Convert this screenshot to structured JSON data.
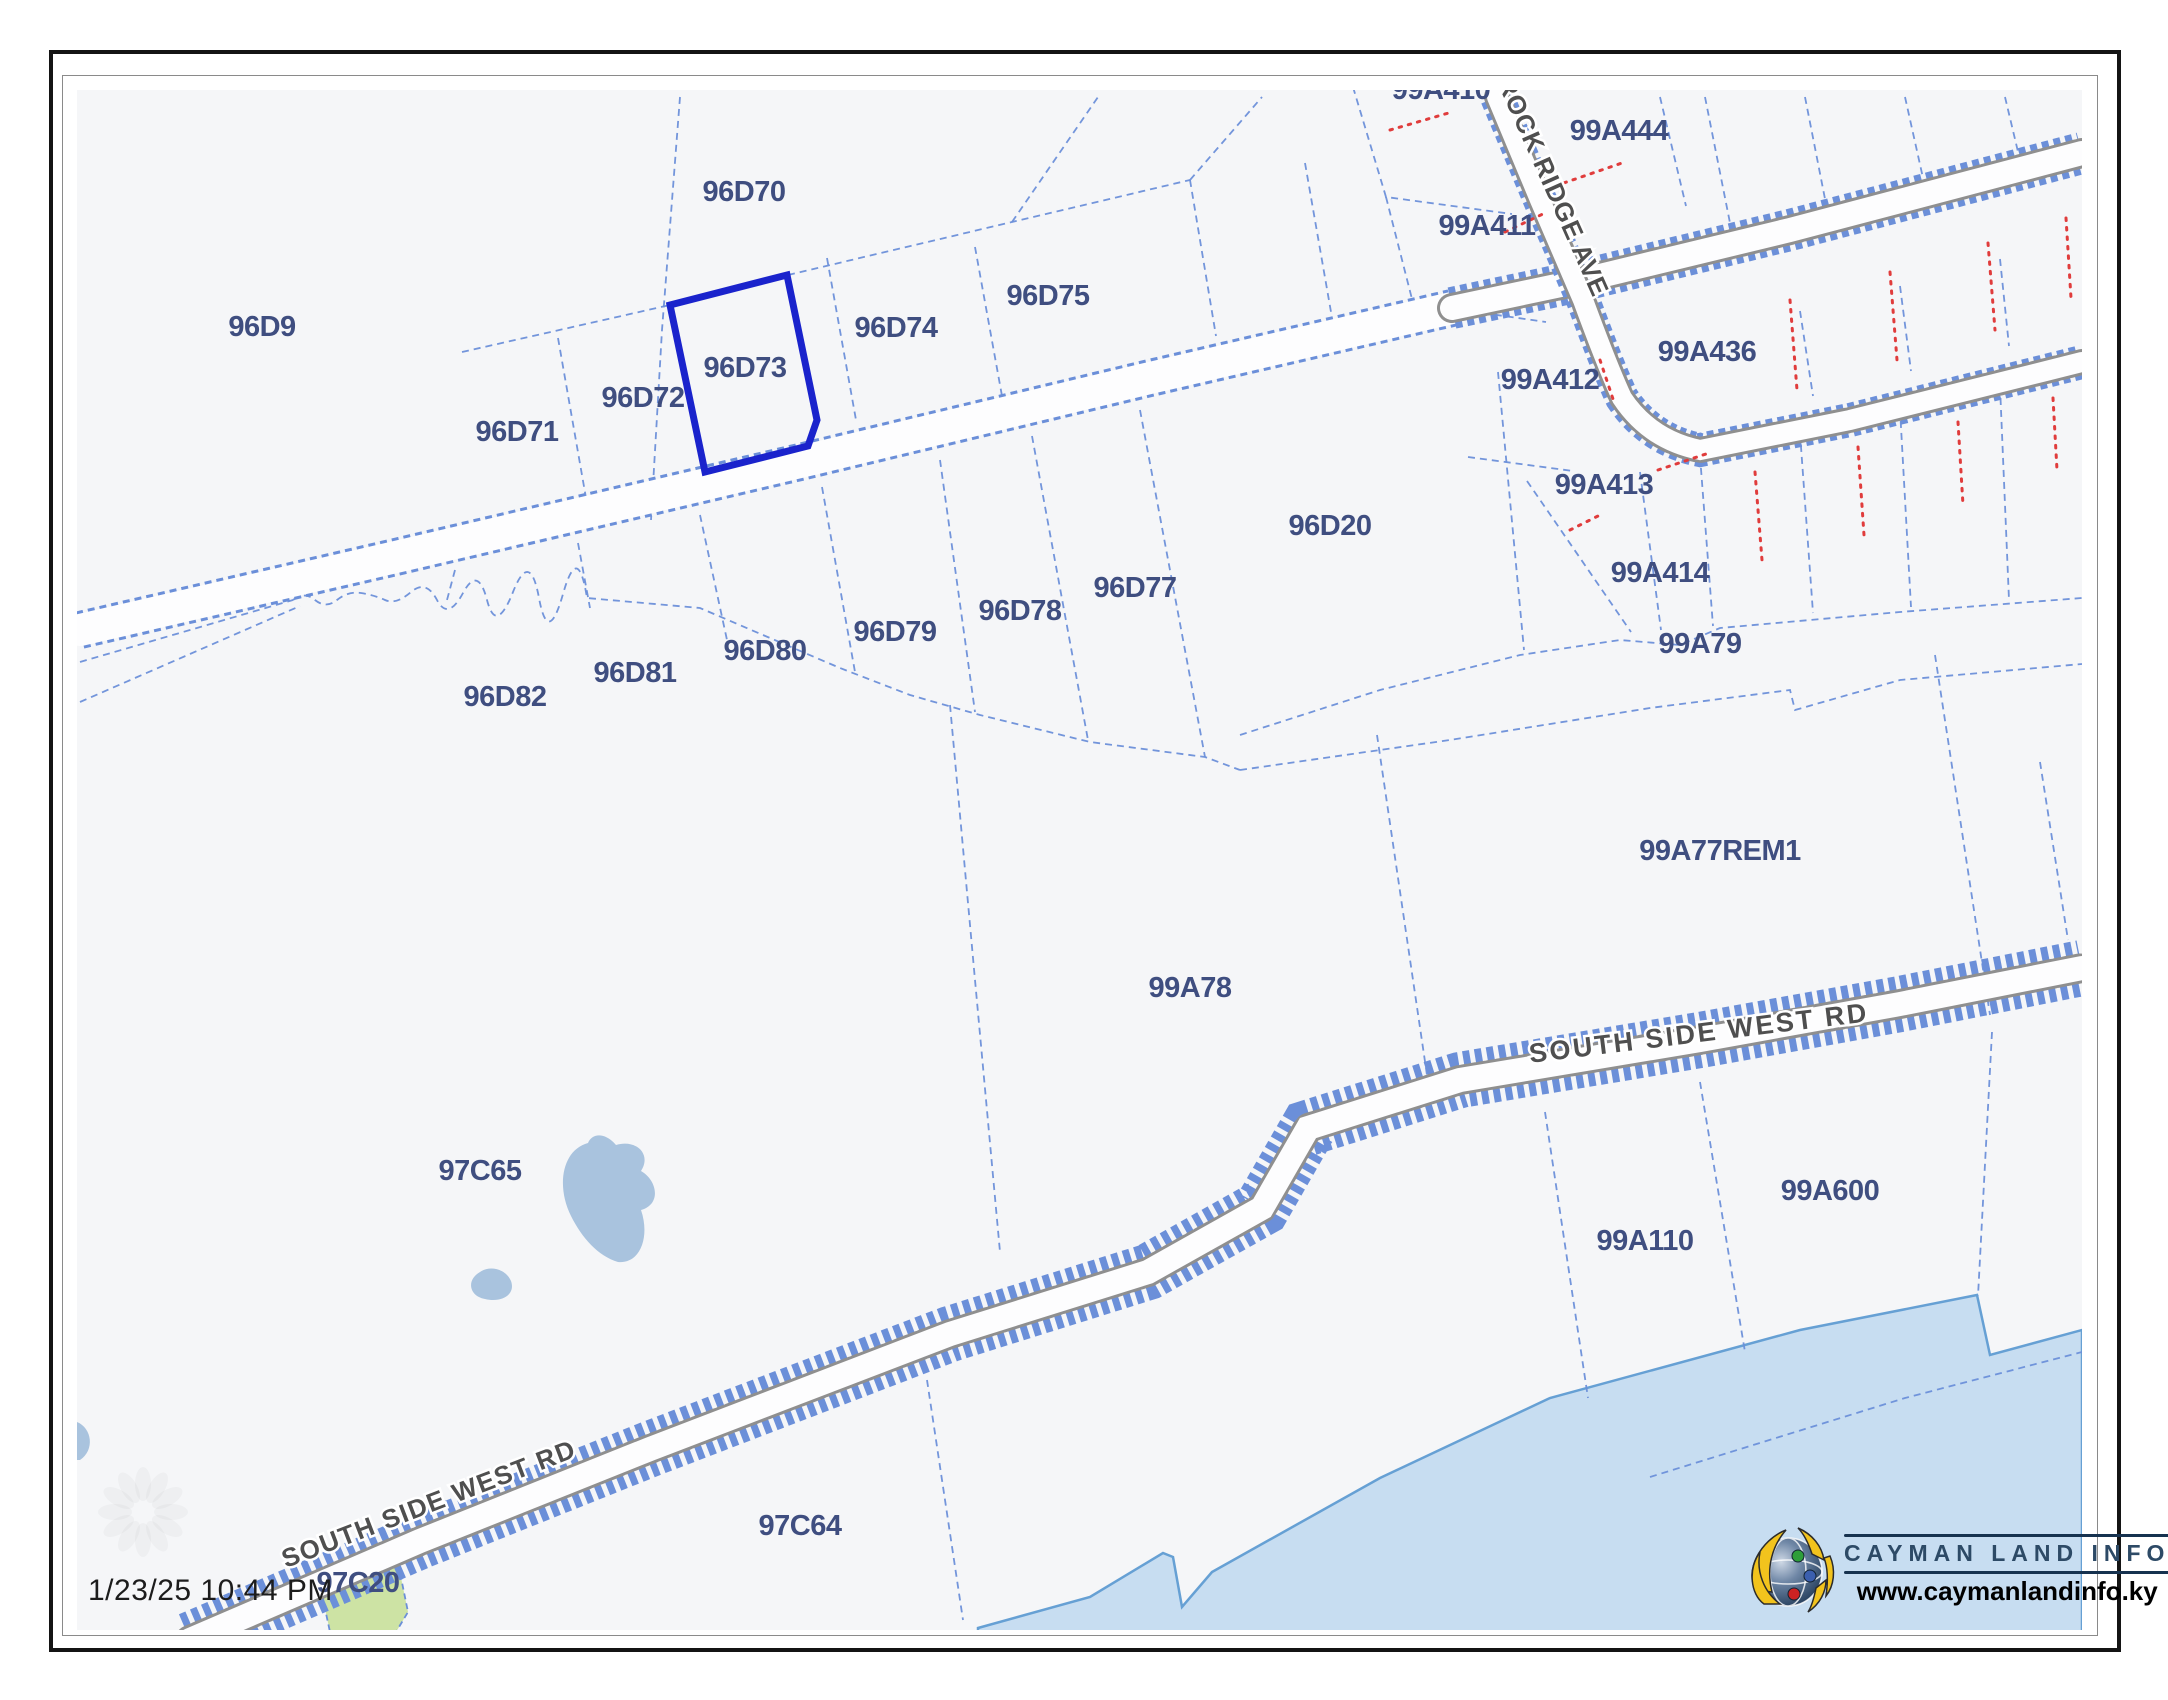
{
  "footer": {
    "timestamp": "1/23/25 10:44 PM"
  },
  "logo": {
    "title": "CAYMAN LAND INFO",
    "url": "www.caymanlandinfo.ky"
  },
  "map": {
    "bg": "#f5f6f8",
    "line_color": "#6b8fd9",
    "label_color": "#3f4e80",
    "road_label_color": "#4f4f4f",
    "road_case_color": "#8f8f8f",
    "road_fill_color": "#fdfdfe",
    "selected_color": "#1a23cc",
    "red_dotted_color": "#e03c3c",
    "sea_fill": "#c7ddf1",
    "sea_stroke": "#66a0d4",
    "pond_fill": "#a9c3de",
    "green_fill": "#cde3a4",
    "selected_parcel": {
      "id": "96D73",
      "path": "M670,305 L787,275 L817,420 L808,446 L705,472 Z"
    },
    "parcel_labels": [
      {
        "text": "96D9",
        "x": 262,
        "y": 336
      },
      {
        "text": "96D70",
        "x": 744,
        "y": 201
      },
      {
        "text": "96D71",
        "x": 517,
        "y": 441
      },
      {
        "text": "96D72",
        "x": 643,
        "y": 407
      },
      {
        "text": "96D73",
        "x": 745,
        "y": 377
      },
      {
        "text": "96D74",
        "x": 896,
        "y": 337
      },
      {
        "text": "96D75",
        "x": 1048,
        "y": 305
      },
      {
        "text": "96D20",
        "x": 1330,
        "y": 535
      },
      {
        "text": "96D77",
        "x": 1135,
        "y": 597
      },
      {
        "text": "96D78",
        "x": 1020,
        "y": 620
      },
      {
        "text": "96D79",
        "x": 895,
        "y": 641
      },
      {
        "text": "96D80",
        "x": 765,
        "y": 660
      },
      {
        "text": "96D81",
        "x": 635,
        "y": 682
      },
      {
        "text": "96D82",
        "x": 505,
        "y": 706
      },
      {
        "text": "99A410",
        "x": 1441,
        "y": 99
      },
      {
        "text": "99A444",
        "x": 1619,
        "y": 140
      },
      {
        "text": "99A411",
        "x": 1487,
        "y": 235
      },
      {
        "text": "99A412",
        "x": 1550,
        "y": 389
      },
      {
        "text": "99A436",
        "x": 1707,
        "y": 361
      },
      {
        "text": "99A413",
        "x": 1604,
        "y": 494
      },
      {
        "text": "99A414",
        "x": 1660,
        "y": 582
      },
      {
        "text": "99A79",
        "x": 1700,
        "y": 653
      },
      {
        "text": "99A77REM1",
        "x": 1720,
        "y": 860
      },
      {
        "text": "99A78",
        "x": 1190,
        "y": 997
      },
      {
        "text": "97C65",
        "x": 480,
        "y": 1180
      },
      {
        "text": "99A110",
        "x": 1645,
        "y": 1250
      },
      {
        "text": "99A600",
        "x": 1830,
        "y": 1200
      },
      {
        "text": "97C64",
        "x": 800,
        "y": 1535
      },
      {
        "text": "97C20",
        "x": 358,
        "y": 1592
      }
    ],
    "road_labels": [
      {
        "text": "ROCK RIDGE AVE",
        "x": 1545,
        "y": 190,
        "rot": 66,
        "size": 26,
        "ls": 1
      },
      {
        "text": "SOUTH SIDE WEST RD",
        "x": 1700,
        "y": 1042,
        "rot": -7,
        "size": 27,
        "ls": 2.5
      },
      {
        "text": "SOUTH SIDE WEST RD",
        "x": 432,
        "y": 1512,
        "rot": -21,
        "size": 26,
        "ls": 1.5
      }
    ],
    "roads": [
      {
        "name": "unpaved-main-road",
        "path": "M80,630 L400,556 L800,462 L1150,378 L1452,308",
        "blue_w": 38,
        "case_w": 0,
        "fill_w": 32
      },
      {
        "name": "main-road-east",
        "path": "M1452,308 L1575,282 L1790,230 L2082,153",
        "blue_w": 42,
        "case_w": 30,
        "fill_w": 24
      },
      {
        "name": "rock-ridge-ave",
        "path": "M1497,97 L1540,200 L1583,300 Q1608,368 1622,398 Q1650,440 1700,450 L1850,420 L2082,362",
        "blue_w": 34,
        "case_w": 26,
        "fill_w": 20
      },
      {
        "name": "south-side-west-rd",
        "path": "M190,1640 L420,1541 L650,1449 L950,1334 L1148,1272 L1262,1208 L1308,1128 L1460,1080 L1700,1040 L1900,1004 L2082,968",
        "blue_w": 56,
        "case_w": 30,
        "fill_w": 24
      }
    ],
    "boundaries": [
      "M680,97 L662,330 L651,520",
      "M462,352 L670,305",
      "M788,275 L1012,222 L1190,180",
      "M558,338 L586,498",
      "M827,258 L856,420",
      "M975,247 L1002,396",
      "M1190,180 L1216,336",
      "M1012,222 L1098,97",
      "M1190,180 L1262,97",
      "M1305,163 L1331,312",
      "M1353,87 L1386,197 L1512,214",
      "M1386,197 L1413,303 L1546,322",
      "M1660,97 L1686,206",
      "M1705,97 L1731,228",
      "M1805,97 L1826,204",
      "M1905,97 L1923,178",
      "M2005,97 L2019,156",
      "M1800,311 L1813,396",
      "M1900,286 L1911,371",
      "M2000,259 L2009,346",
      "M1700,456 L1713,626",
      "M1800,433 L1813,613",
      "M1900,409 L1911,607",
      "M2000,386 L2009,600",
      "M1640,472 L1661,630",
      "M1498,372 L1524,650",
      "M1468,457 L1573,471",
      "M1527,481 L1631,632",
      "M1140,410 L1205,757",
      "M1032,436 L1088,740",
      "M940,460 L975,712",
      "M822,487 L855,672",
      "M700,515 L727,640",
      "M578,543 L590,608",
      "M455,570 L447,600",
      "M80,662 L293,600",
      "M80,702 L300,606",
      "M293,600 q11,-9 22,0 t22,0 t24,-7 t24,7 t26,-8 t26,8 t26,-7 t24,7 t26,-8 t26,6 t24,-4 t24,4 L700,608 L770,638 L840,668 L910,695 L980,715 L1090,742 L1205,757 L1240,770",
      "M1240,735 L1380,690 L1520,655 L1620,640 L1680,645 L1720,628 L1900,612 L2082,598",
      "M1240,770 L1450,740 L1650,708 L1790,690 L1795,710 L1900,680 L2082,664",
      "M1377,735 L1428,1082",
      "M950,705 L975,980 L1000,1252",
      "M1935,655 L1990,1015",
      "M2040,762 L2068,940",
      "M927,1380 L963,1620",
      "M1545,1112 L1588,1398",
      "M1700,1082 L1745,1352",
      "M1992,1032 L1978,1296",
      "M1650,1477 L1905,1398 L2082,1352"
    ],
    "red_dotted": [
      "M1390,130 L1452,112",
      "M1555,186 L1622,163",
      "M1505,232 L1545,213",
      "M1600,360 L1615,405",
      "M1570,530 L1600,515",
      "M1658,470 L1712,452",
      "M1790,300 L1797,390",
      "M1890,272 L1897,360",
      "M1988,243 L1995,330",
      "M2066,218 L2071,298",
      "M1755,472 L1762,560",
      "M1858,447 L1864,535",
      "M1958,422 L1963,505",
      "M2053,398 L2057,470"
    ],
    "sea_path": "M978,1628 L1090,1597 L1163,1553 L1173,1557 L1182,1607 L1212,1572 L1380,1478 L1550,1398 L1800,1330 L1977,1295 L1990,1355 L2082,1330 L2082,1632 L978,1632 Z",
    "green_path": "M320,1585 L395,1548 L408,1612 L396,1632 L330,1632 Z",
    "ponds": [
      "M588,1143 C562,1150 556,1186 571,1216 C582,1238 598,1256 618,1262 C641,1264 650,1236 641,1210 C662,1204 657,1180 641,1171 C652,1154 636,1139 616,1145 C605,1132 592,1133 588,1143 Z",
      "M480,1272 C466,1280 469,1296 485,1299 C501,1303 516,1295 511,1281 C506,1269 490,1265 480,1272 Z",
      "M77,1422 C92,1428 95,1450 80,1460 L77,1460 Z"
    ],
    "watermark": {
      "x": 143,
      "y": 1512,
      "r": 28,
      "petals": 12,
      "opacity": 0.045
    }
  }
}
